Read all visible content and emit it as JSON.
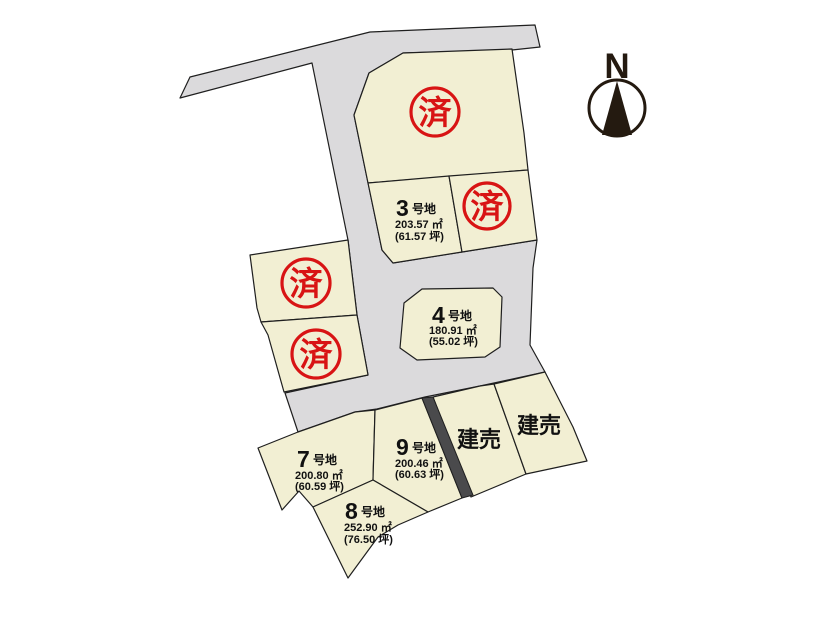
{
  "compass": {
    "label": "N"
  },
  "colors": {
    "background": "#ffffff",
    "lot_fill": "#f2efd3",
    "road_fill": "#dbdadc",
    "outline": "#1f1f1f",
    "stamp_red": "#d81414",
    "stripe_dark": "#4a4a4c",
    "compass_dark": "#241a10"
  },
  "sold_stamps": [
    {
      "label": "済"
    },
    {
      "label": "済"
    },
    {
      "label": "済"
    },
    {
      "label": "済"
    }
  ],
  "lots": {
    "lot3": {
      "number": "3",
      "suffix": "号地",
      "area_m2": "203.57 ㎡",
      "area_tsubo": "(61.57 坪)"
    },
    "lot4": {
      "number": "4",
      "suffix": "号地",
      "area_m2": "180.91 ㎡",
      "area_tsubo": "(55.02 坪)"
    },
    "lot7": {
      "number": "7",
      "suffix": "号地",
      "area_m2": "200.80 ㎡",
      "area_tsubo": "(60.59 坪)"
    },
    "lot8": {
      "number": "8",
      "suffix": "号地",
      "area_m2": "252.90 ㎡",
      "area_tsubo": "(76.50 坪)"
    },
    "lot9": {
      "number": "9",
      "suffix": "号地",
      "area_m2": "200.46 ㎡",
      "area_tsubo": "(60.63 坪)"
    },
    "tateuri1": {
      "label": "建売"
    },
    "tateuri2": {
      "label": "建売"
    }
  }
}
